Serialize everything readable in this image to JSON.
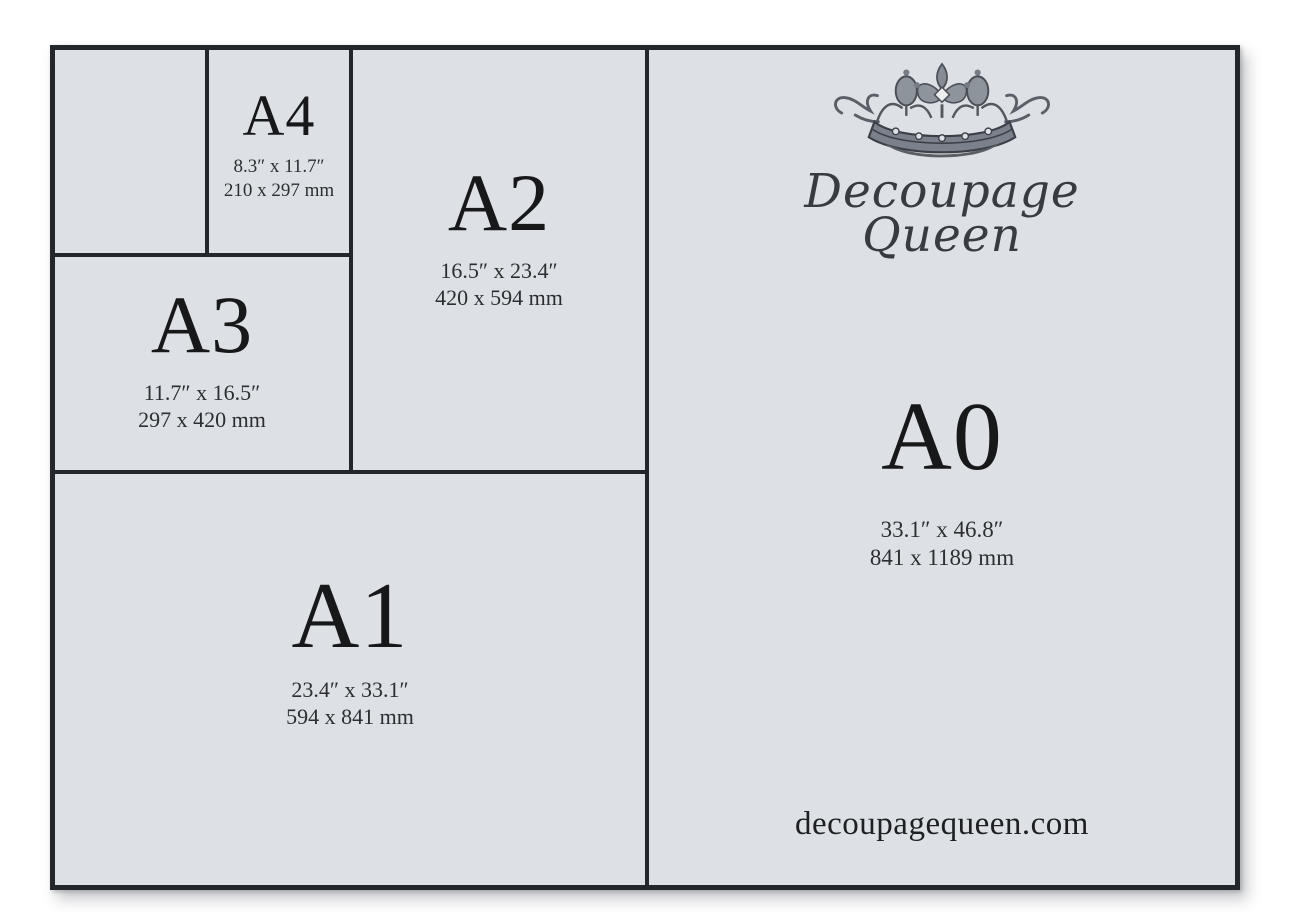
{
  "page": {
    "background": "#ffffff",
    "panel_bg": "#dde1e6",
    "line_color": "#23262b",
    "label_color": "#17181a"
  },
  "cells": {
    "a4": {
      "label": "A4",
      "inches": "8.3″ x 11.7″",
      "mm": "210 x 297 mm"
    },
    "a3": {
      "label": "A3",
      "inches": "11.7″ x 16.5″",
      "mm": "297 x 420 mm"
    },
    "a2": {
      "label": "A2",
      "inches": "16.5″ x 23.4″",
      "mm": "420 x 594 mm"
    },
    "a1": {
      "label": "A1",
      "inches": "23.4″ x 33.1″",
      "mm": "594 x 841 mm"
    },
    "a0": {
      "label": "A0",
      "inches": "33.1″ x 46.8″",
      "mm": "841 x 1189 mm"
    }
  },
  "brand": {
    "name_line1": "Decoupage",
    "name_line2": "Queen",
    "website": "decoupagequeen.com",
    "crown_icon": "crown-icon"
  }
}
